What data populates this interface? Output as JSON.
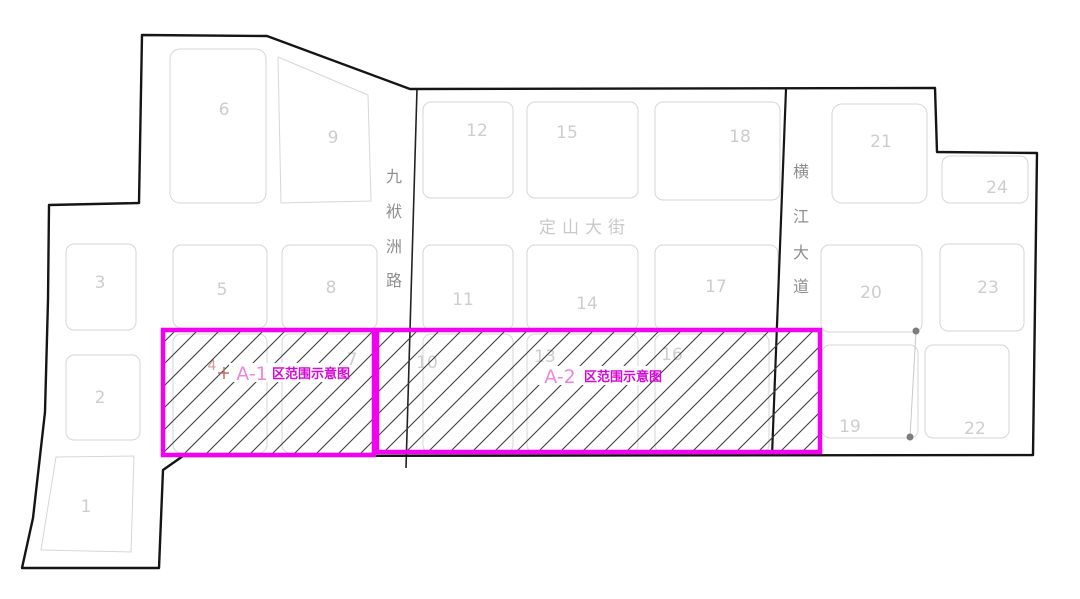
{
  "figure": {
    "type": "land-parcel-zoning-plan",
    "background": "#ffffff"
  },
  "colors": {
    "boundary": "#151515",
    "parcel_outline": "#d6d6d6",
    "parcel_number": "#cdcdcd",
    "road_label_dark": "#8e8e8e",
    "road_label_light": "#c9c9c9",
    "zone_border": "#f100f1",
    "zone_prefix_text": "#ef86dc",
    "zone_suffix_text": "#d40ad4",
    "hatch_line": "#3d3d3d",
    "dot": "#7d7d7d",
    "marker_red": "#c06a6a"
  },
  "roads": {
    "jiufuzhou": {
      "name": "九袱洲路",
      "chars": [
        "九",
        "袱",
        "洲",
        "路"
      ],
      "orientation": "vertical"
    },
    "dingshan": {
      "name": "定山大街",
      "orientation": "horizontal"
    },
    "hengjiang": {
      "name": "横江大道",
      "chars": [
        "横",
        "江",
        "大",
        "道"
      ],
      "orientation": "vertical"
    }
  },
  "zones": {
    "a1": {
      "prefix": "A-1",
      "suffix": "区范围示意图"
    },
    "a2": {
      "prefix": "A-2",
      "suffix": "区范围示意图"
    }
  },
  "markers": {
    "plus": "+"
  },
  "parcels": [
    {
      "label": "1"
    },
    {
      "label": "2"
    },
    {
      "label": "3"
    },
    {
      "label": "4"
    },
    {
      "label": "5"
    },
    {
      "label": "6"
    },
    {
      "label": "7"
    },
    {
      "label": "8"
    },
    {
      "label": "9"
    },
    {
      "label": "10"
    },
    {
      "label": "11"
    },
    {
      "label": "12"
    },
    {
      "label": "13"
    },
    {
      "label": "14"
    },
    {
      "label": "15"
    },
    {
      "label": "16"
    },
    {
      "label": "17"
    },
    {
      "label": "18"
    },
    {
      "label": "19"
    },
    {
      "label": "20"
    },
    {
      "label": "21"
    },
    {
      "label": "22"
    },
    {
      "label": "23"
    },
    {
      "label": "24"
    }
  ]
}
